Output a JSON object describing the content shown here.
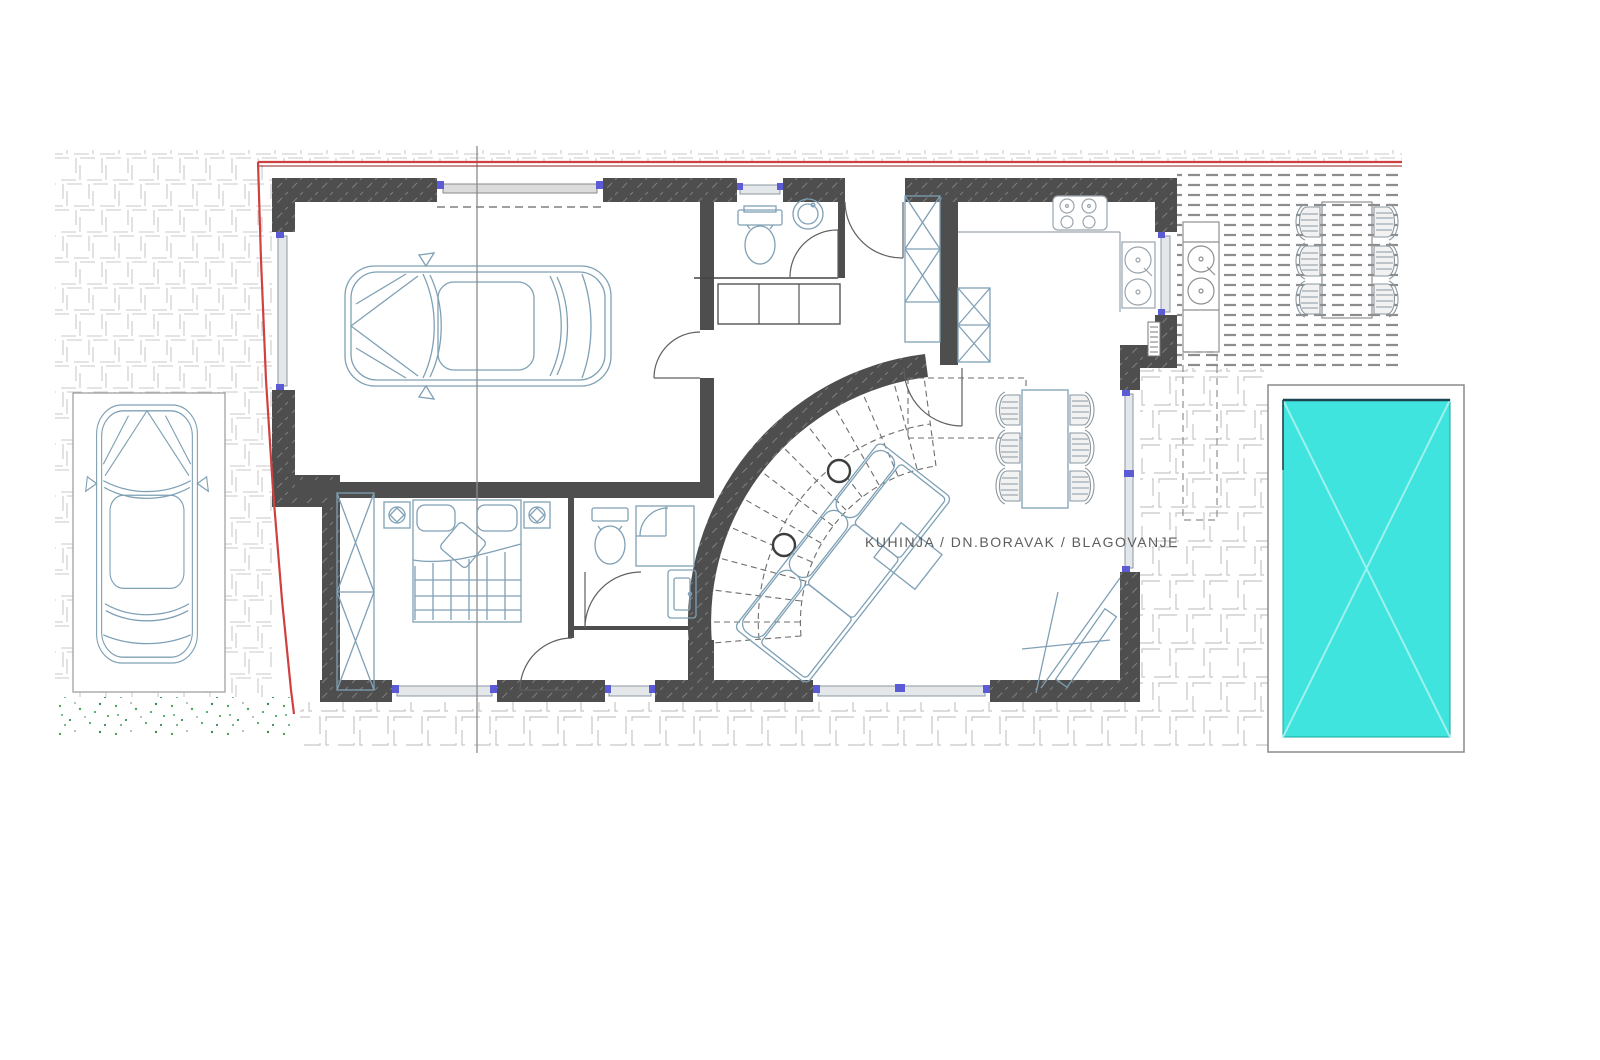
{
  "labels": {
    "living_area": "KUHINJA  /  DN.BORAVAK  /  BLAGOVANJE"
  },
  "colors": {
    "wall": "#4e4e4e",
    "pool_water": "#3fe4de",
    "pool_cross": "#9ef1ed",
    "pool_edge": "#1d4450",
    "boundary_line": "#cf4040",
    "boundary_line_dark": "#8e2222",
    "furniture_line": "#7fa0b5",
    "tile_line": "#c9c9c9",
    "deck_line": "#8d8d8d",
    "grass_dot": "#49a75f",
    "window_mark": "#5b5bd6",
    "section_line": "#8c8c8c"
  },
  "plan": {
    "floor": "ground-floor",
    "rooms": [
      {
        "name": "garage"
      },
      {
        "name": "wc"
      },
      {
        "name": "hall"
      },
      {
        "name": "bedroom"
      },
      {
        "name": "bathroom"
      },
      {
        "name": "kitchen-living-dining",
        "label": "KUHINJA  /  DN.BORAVAK  /  BLAGOVANJE"
      }
    ],
    "outdoor": [
      {
        "name": "swimming-pool"
      },
      {
        "name": "wooden-deck"
      },
      {
        "name": "parking-space"
      },
      {
        "name": "lawn-strip"
      },
      {
        "name": "paved-yard"
      }
    ],
    "furniture": [
      "car-in-garage",
      "car-on-parking",
      "double-bed",
      "wardrobe",
      "sofa",
      "coffee-table",
      "dining-table-6-chairs",
      "outdoor-table-6-chairs",
      "cooktop",
      "kitchen-sinks",
      "outdoor-sinks",
      "toilet",
      "washbasin",
      "shower-cabin",
      "spiral-staircase"
    ]
  }
}
